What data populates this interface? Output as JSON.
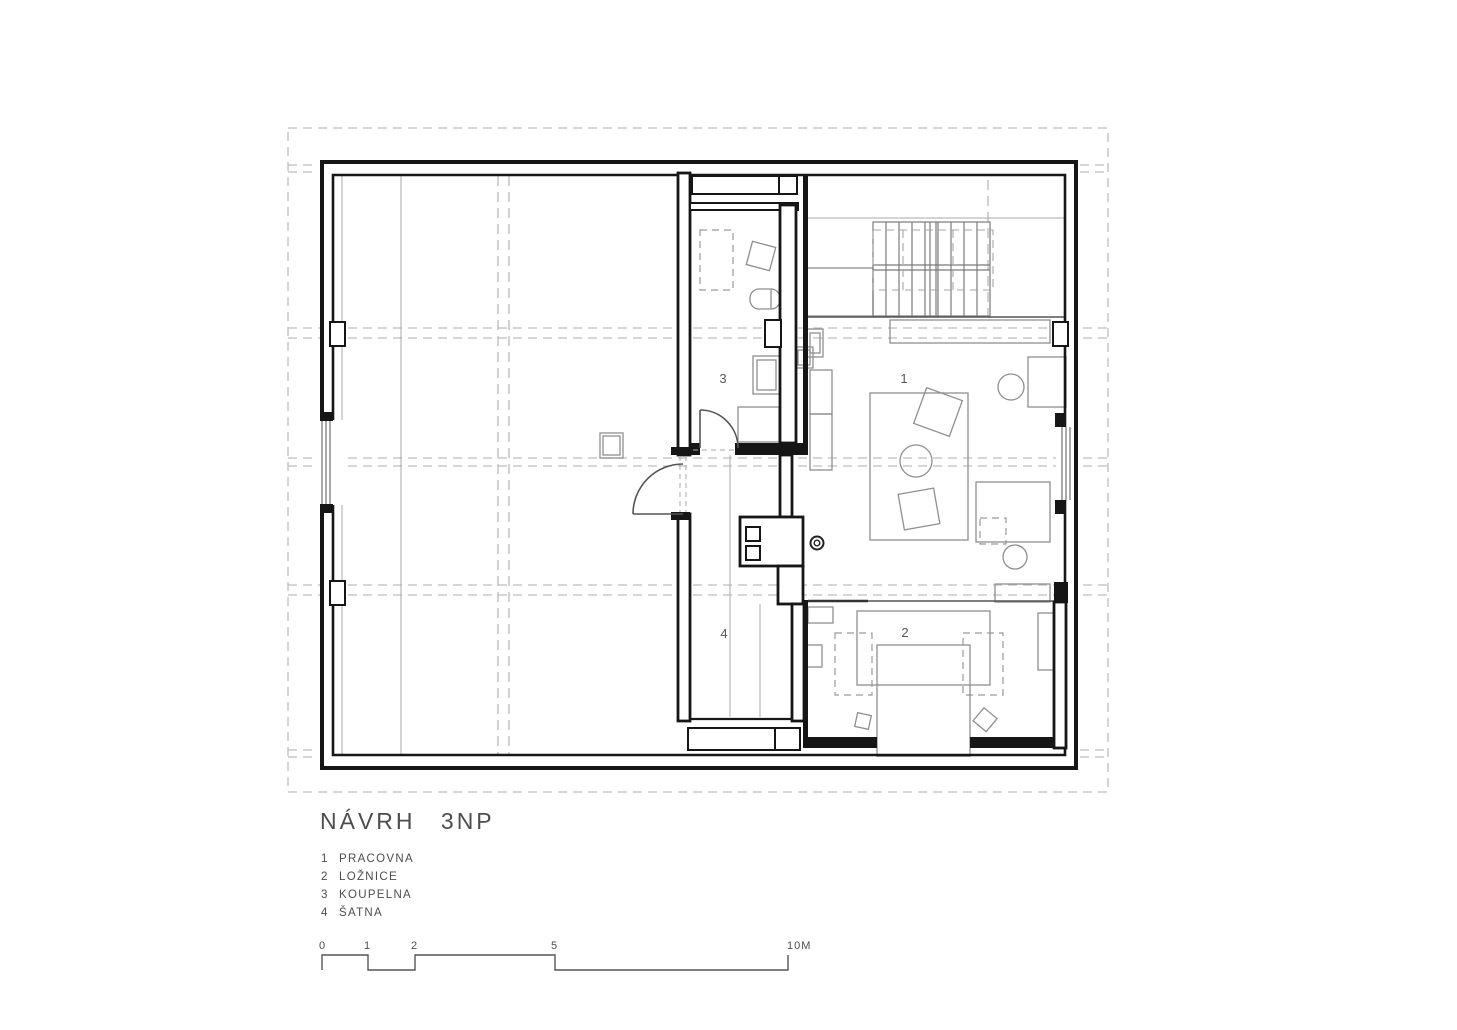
{
  "drawing": {
    "title": "NÁVRH 3NP",
    "legend": [
      {
        "num": "1",
        "label": "PRACOVNA"
      },
      {
        "num": "2",
        "label": "LOŽNICE"
      },
      {
        "num": "3",
        "label": "KOUPELNA"
      },
      {
        "num": "4",
        "label": "ŠATNA"
      }
    ],
    "room_numbers": {
      "pracovna": "1",
      "loznice": "2",
      "koupelna": "3",
      "satna": "4"
    },
    "scale": {
      "ticks": [
        "0",
        "1",
        "2",
        "5",
        "10M"
      ]
    },
    "colors": {
      "wall": "#161616",
      "furniture": "#8f8f8f",
      "roof_dashed": "#bdbdbd",
      "text": "#4d4d4d",
      "background": "#ffffff"
    }
  }
}
